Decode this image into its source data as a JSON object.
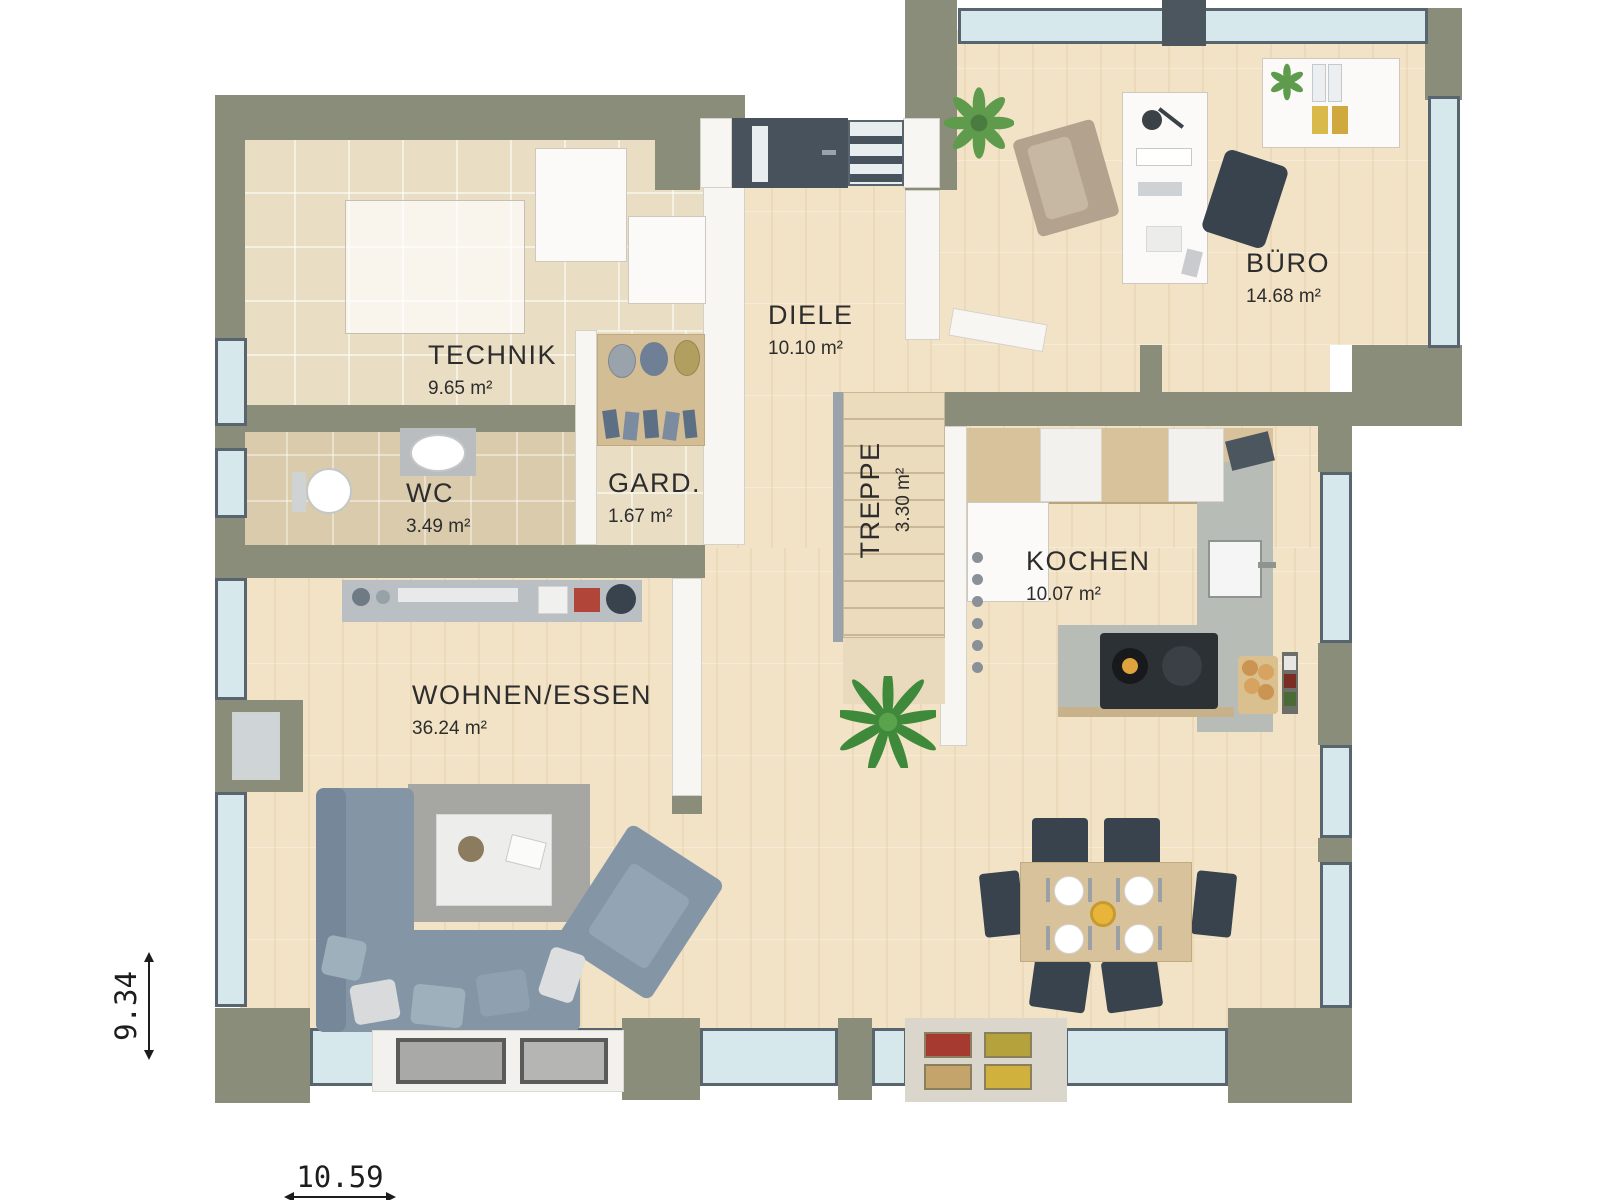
{
  "type": "floor-plan",
  "rooms": [
    {
      "id": "technik",
      "name": "TECHNIK",
      "area": "9.65 m²"
    },
    {
      "id": "wc",
      "name": "WC",
      "area": "3.49 m²"
    },
    {
      "id": "gard",
      "name": "GARD.",
      "area": "1.67 m²"
    },
    {
      "id": "diele",
      "name": "DIELE",
      "area": "10.10 m²"
    },
    {
      "id": "treppe",
      "name": "TREPPE",
      "area": "3.30 m²"
    },
    {
      "id": "buero",
      "name": "BÜRO",
      "area": "14.68 m²"
    },
    {
      "id": "kochen",
      "name": "KOCHEN",
      "area": "10.07 m²"
    },
    {
      "id": "wohnen",
      "name": "WOHNEN/ESSEN",
      "area": "36.24 m²"
    }
  ],
  "dimensions": {
    "height_label": "9.34",
    "width_label": "10.59"
  },
  "colors": {
    "wall": "#8a8d7a",
    "floor_wood": "#f3e3c6",
    "floor_tile": "#e9ddc3",
    "glass": "#d7e8ec",
    "window_frame": "#58656e",
    "sofa": "#8496a6",
    "counter_gray": "#b7bcb7",
    "cabinet_wood": "#d8c29c",
    "chair_dark": "#39434d",
    "plant_green": "#5e9b4d",
    "door_dark": "#47525c"
  },
  "furniture": [
    "sofa",
    "armchair",
    "coffee-table",
    "rug",
    "sideboard",
    "dining-table",
    "dining-chairs",
    "kitchen-island",
    "cooktop",
    "kitchen-counter",
    "sink",
    "stairs",
    "front-door",
    "desk",
    "office-chair",
    "lounge-chair",
    "shelf",
    "wardrobe",
    "toilet",
    "washbasin",
    "plants",
    "hvac-units",
    "picture-frames"
  ]
}
